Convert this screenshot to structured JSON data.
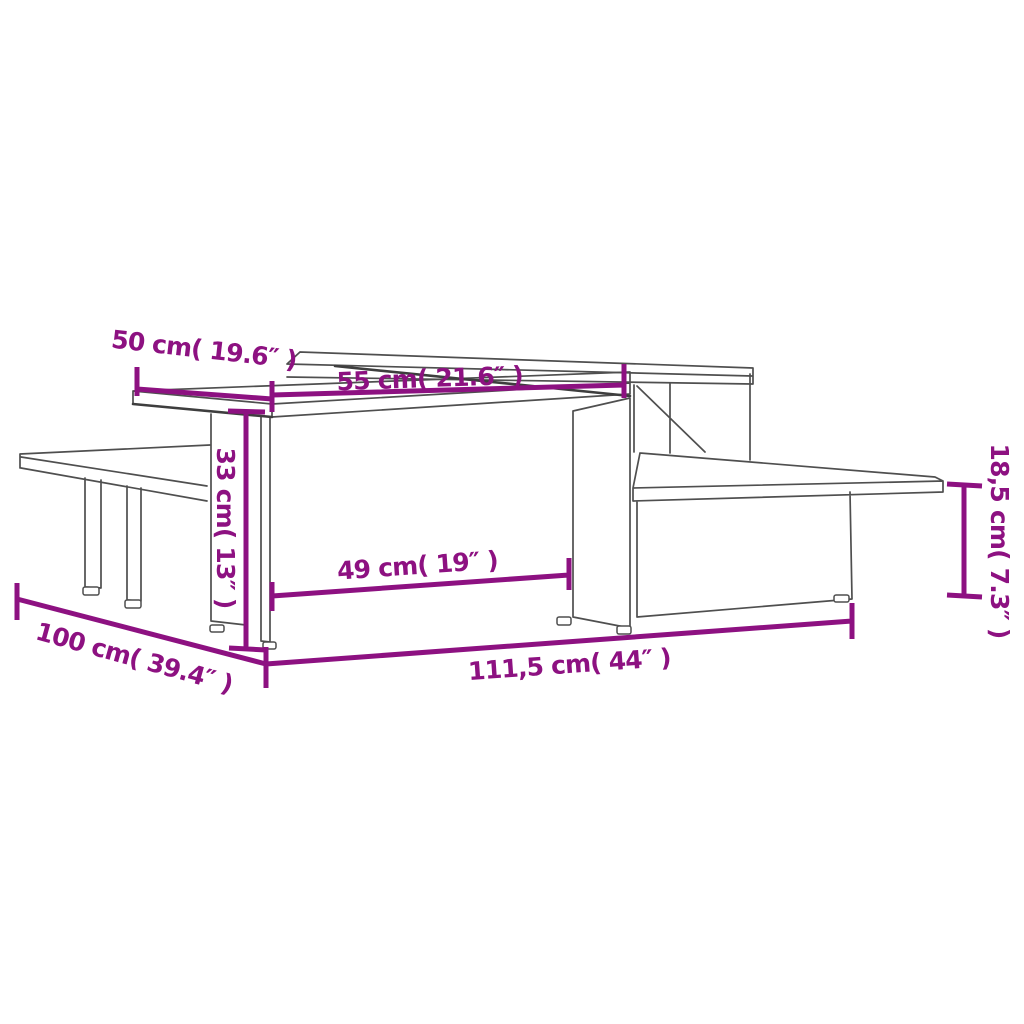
{
  "diagram": {
    "kind": "furniture-dimension-diagram",
    "background_color": "#ffffff",
    "accent_color": "#8D1181",
    "outline_color": "#4f4f4f",
    "dimensions": {
      "top_depth": "50 cm( 19.6″ )",
      "top_length": "55 cm( 21.6″ )",
      "table_height": "33 cm( 13″ )",
      "inner_width": "49 cm( 19″ )",
      "total_length": "111,5 cm( 44″ )",
      "total_depth": "100 cm( 39.4″ )",
      "shelf_height": "18,5 cm( 7.3″ )"
    }
  }
}
